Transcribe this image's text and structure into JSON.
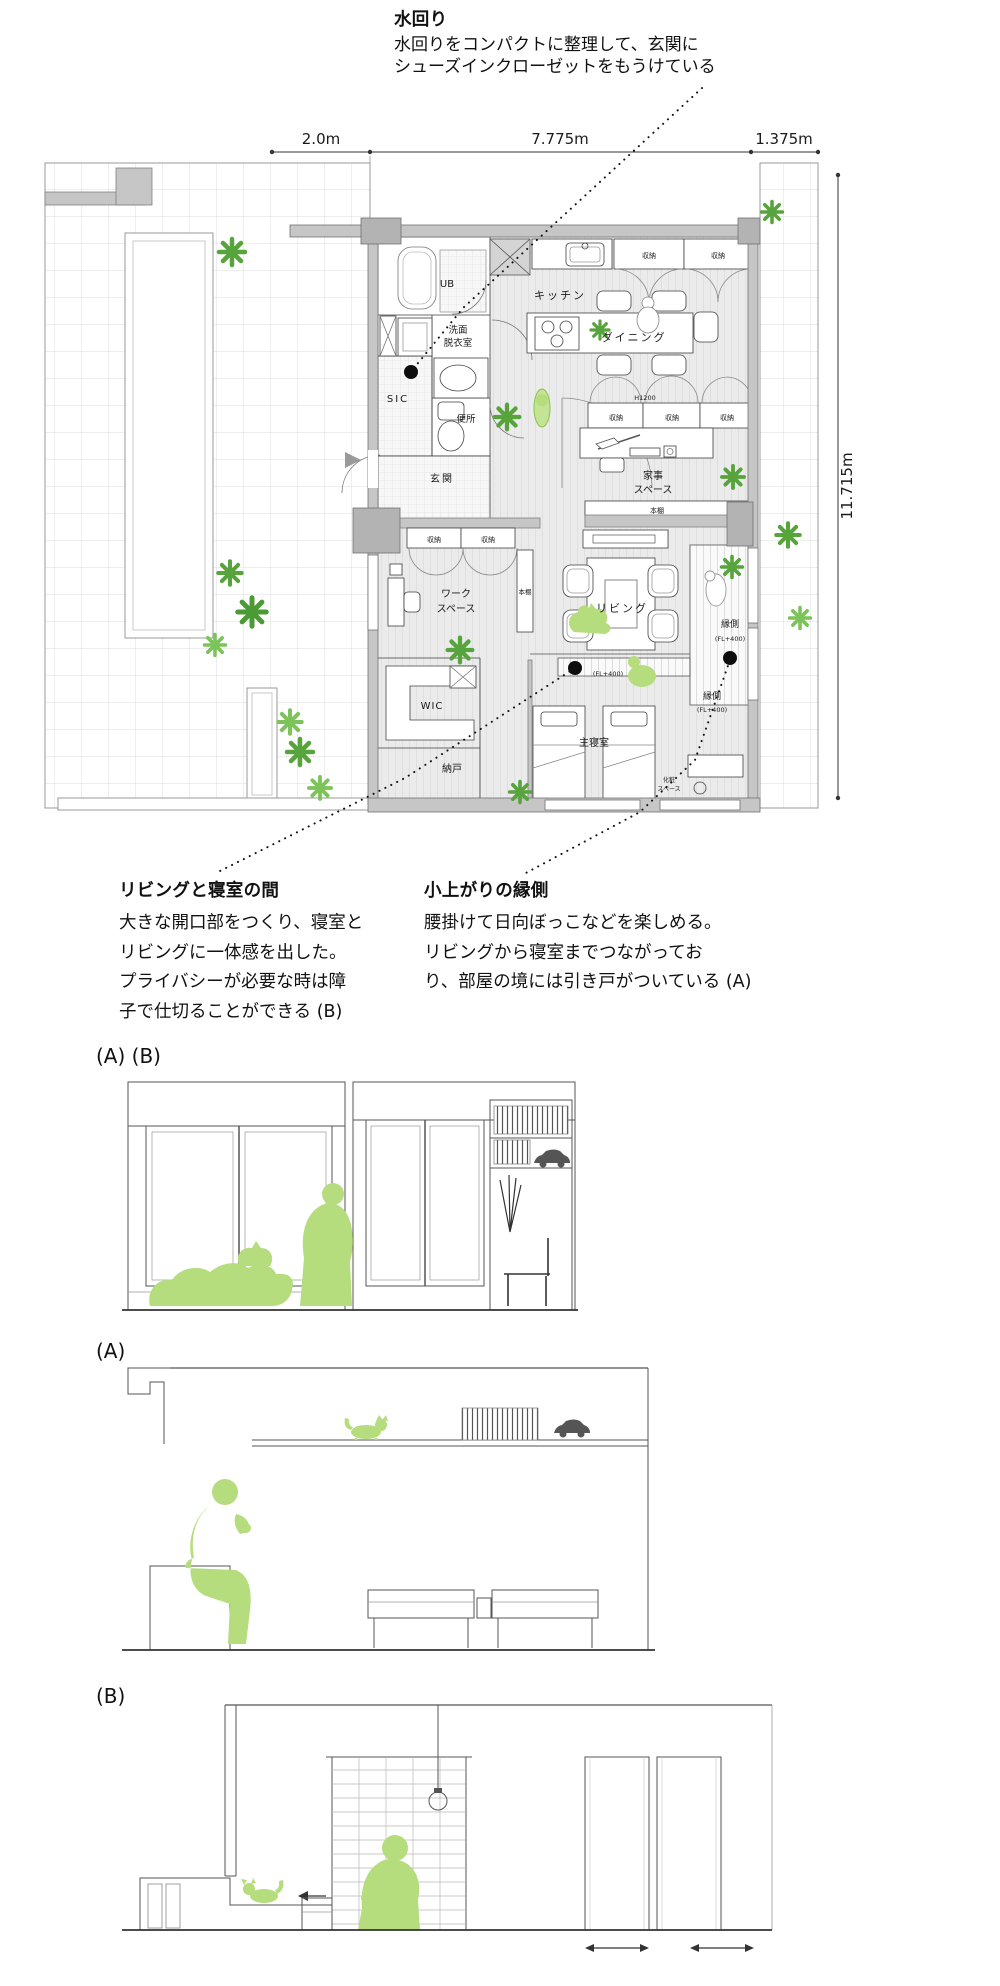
{
  "annotations": {
    "mizumawari": {
      "title": "水回り",
      "lines": [
        "水回りをコンパクトに整理して、玄関に",
        "シューズインクローゼットをもうけている"
      ]
    },
    "living_bedroom": {
      "title": "リビングと寝室の間",
      "lines": [
        "大きな開口部をつくり、寝室と",
        "リビングに一体感を出した。",
        "プライバシーが必要な時は障",
        "子で仕切ることができる (B)"
      ]
    },
    "koagari": {
      "title": "小上がりの縁側",
      "lines": [
        "腰掛けて日向ぼっこなどを楽しめる。",
        "リビングから寝室までつながってお",
        "り、部屋の境には引き戸がついている (A)"
      ]
    }
  },
  "dimensions": {
    "top1": "2.0m",
    "top2": "7.775m",
    "top3": "1.375m",
    "right": "11.715m"
  },
  "plan_labels": {
    "ub": "UB",
    "senmen1": "洗面",
    "senmen2": "脱衣室",
    "sic": "SIC",
    "benjo": "便所",
    "genkan": "玄関",
    "kitchen": "キッチン",
    "dining": "ダイニング",
    "shuno": "収納",
    "h1200": "H1200",
    "kaji1": "家事",
    "kaji2": "スペース",
    "hondana": "本棚",
    "work1": "ワーク",
    "work2": "スペース",
    "living": "リビング",
    "engawa": "縁側",
    "fl400": "(FL+400)",
    "wic": "WIC",
    "nando": "納戸",
    "shushin": "主寝室",
    "kesho1": "化粧",
    "kesho2": "スペース"
  },
  "sections": {
    "ab": "(A) (B)",
    "a": "(A)",
    "b": "(B)"
  },
  "colors": {
    "plant_dark": "#57a33c",
    "plant_light": "#7cc45a",
    "figure": "#b5dd7d",
    "wall": "#c6c6c6"
  }
}
